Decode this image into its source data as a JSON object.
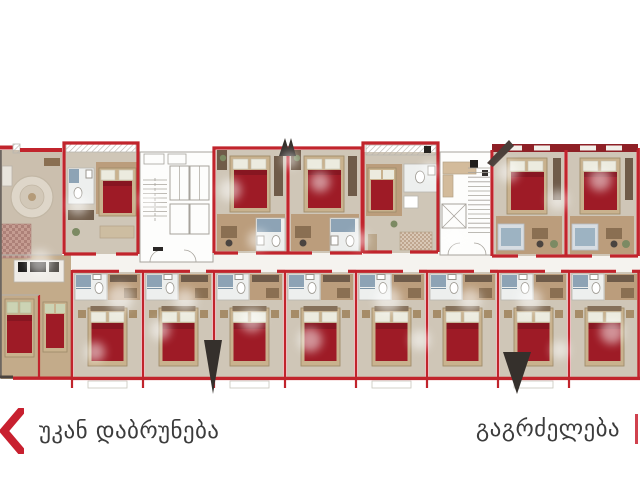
{
  "app": {
    "background_color": "#ffffff",
    "view": "building-floor-plan-selector"
  },
  "nav": {
    "back": {
      "label": "უკან დაბრუნება",
      "icon": "chevron-left",
      "accent_color": "#c8202f",
      "text_color": "#3c3c3c"
    },
    "continue": {
      "label": "გაგრძელება",
      "icon": "chevron-right",
      "accent_color": "#c8202f",
      "text_color": "#3c3c3c"
    }
  },
  "floorplan": {
    "kind": "apartment-building-floor-plan",
    "colors": {
      "wall": "#c1242c",
      "wall_dark": "#8e2026",
      "outline_gray": "#a7a39c",
      "floor": "#cfc6b7",
      "wood": "#bb9d7c",
      "wood_light": "#c9b594",
      "bed_cover": "#9e1b26",
      "bed_cover_dark": "#871621",
      "bed_frame": "#c9b28e",
      "bed_frame_edge": "#a08c6b",
      "mattress": "#dbd0ba",
      "pillow": "#ecebdf",
      "bath_floor": "#edefee",
      "shower": "#8da3b5",
      "wardrobe": "#6f5b49",
      "desk": "#8a6f52",
      "sofa_blue": "#9db3c2",
      "corridor": "#f5f3ef",
      "core_floor": "#fdfdfc",
      "rug": "#ded6c9",
      "accent_green": "#7c8a63",
      "marker_dark": "#35302c"
    },
    "units": {
      "apartment": {
        "id": "apartment-a"
      },
      "top_row": [
        {
          "id": "suite-b"
        },
        {
          "id": "suite-c"
        },
        {
          "id": "suite-d"
        },
        {
          "id": "suite-e"
        },
        {
          "id": "suite-f"
        },
        {
          "id": "suite-g"
        }
      ],
      "bottom_row": [
        {
          "id": "room-1"
        },
        {
          "id": "room-2"
        },
        {
          "id": "room-3"
        },
        {
          "id": "room-4"
        },
        {
          "id": "room-5"
        },
        {
          "id": "room-6"
        },
        {
          "id": "room-7"
        },
        {
          "id": "room-8"
        }
      ],
      "cores": [
        {
          "id": "core-a",
          "features": [
            "stairs",
            "elevators"
          ]
        },
        {
          "id": "core-b",
          "features": [
            "stairs",
            "elevator",
            "lobby"
          ]
        }
      ]
    }
  }
}
